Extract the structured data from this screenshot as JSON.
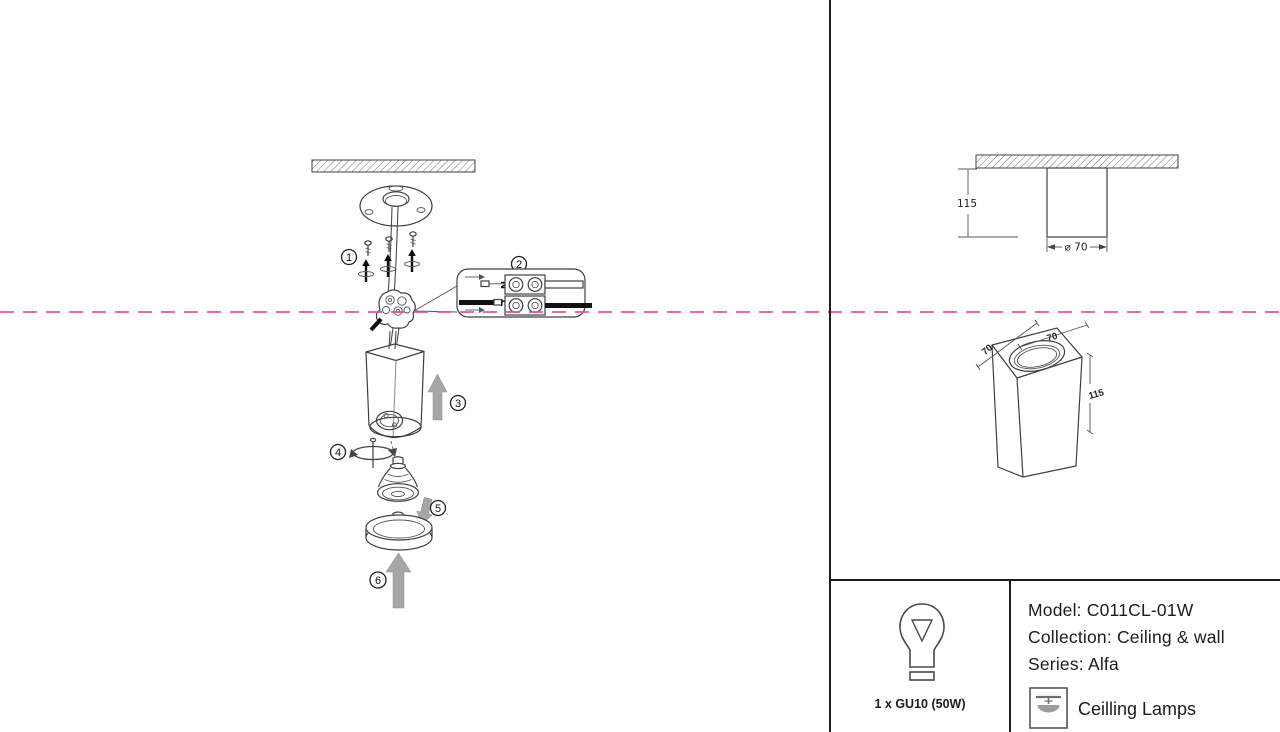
{
  "colors": {
    "centerline": "#e2529e",
    "divider": "#1a1a1a",
    "arrow_gray": "#a6a6a6",
    "outline": "#3f3f3f"
  },
  "steps": [
    "1",
    "2",
    "3",
    "4",
    "5",
    "6"
  ],
  "connector": {
    "neutral": "N",
    "live": "L"
  },
  "dims": {
    "side_height": "115",
    "side_diameter": "⌀ 70",
    "iso_depth": "70",
    "iso_width": "70",
    "iso_height": "115"
  },
  "info": {
    "bulb_spec": "1 x GU10 (50W)",
    "model": "Model: C011CL-01W",
    "collection": "Collection: Ceiling & wall",
    "series": "Series: Alfa",
    "category": "Ceilling Lamps"
  }
}
